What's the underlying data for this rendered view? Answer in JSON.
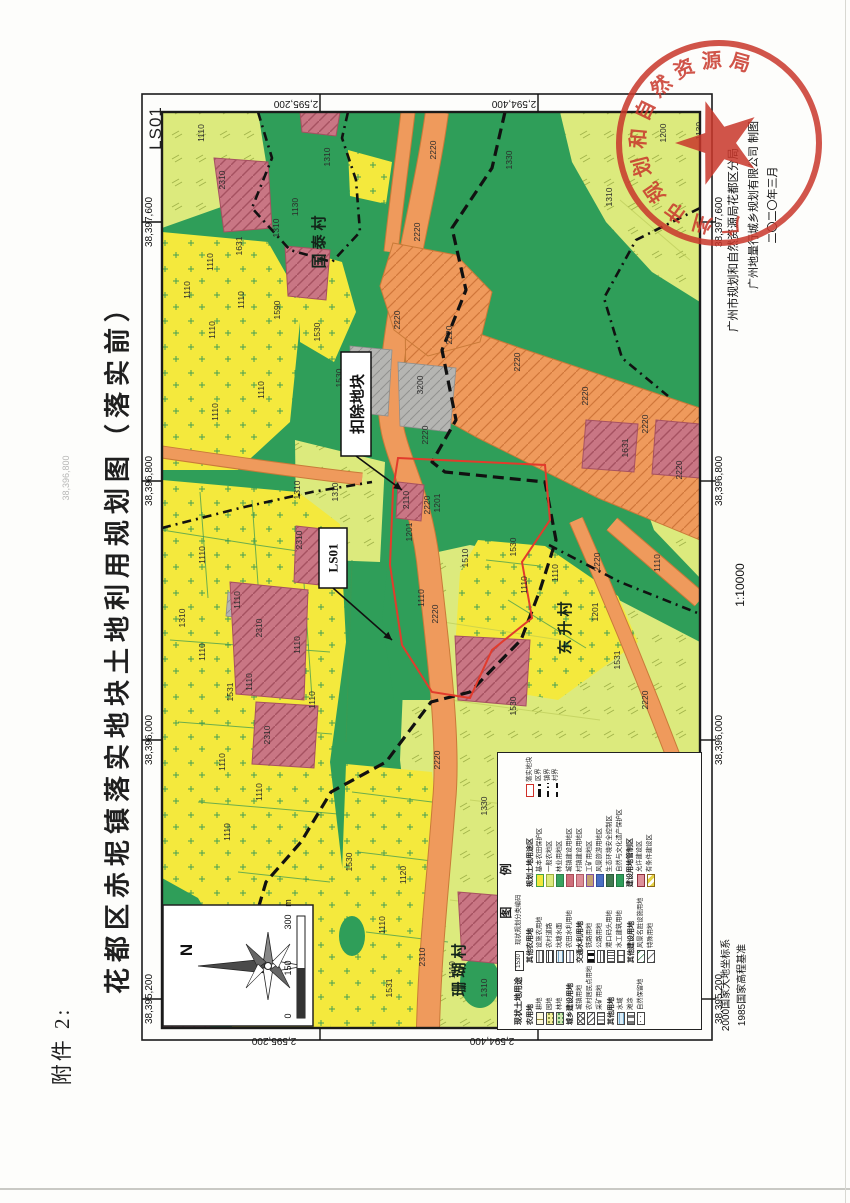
{
  "page": {
    "attachment_label": "附件 2:",
    "sheet_code": "LS01",
    "title": "花都区赤坭镇落实地块土地利用规划图（落实前）",
    "scale_text": "1:10000",
    "datum_line1": "2000国家大地坐标系",
    "datum_line2": "1985国家高程基准",
    "credit_line1": "广州市规划和自然资源局花都区分局",
    "credit_line2": "广州地量行城乡规划有限公司  制图",
    "credit_line3": "二〇二〇年三月",
    "ghost_label": "38,396,800"
  },
  "seal": {
    "arc_text": "广州市规划和自然资源局花都区分局",
    "color": "#c9372b"
  },
  "colors": {
    "green": "#2f9e59",
    "yellow": "#f4e93d",
    "ygreen": "#dcea7d",
    "orange": "#ef9a5c",
    "orange_edge": "#c97a38",
    "pink": "#c97684",
    "gray": "#b5b5b2",
    "red_line": "#e23b2c",
    "frame": "#1b1b1b"
  },
  "compass": {
    "north_label": "N",
    "scalebar_labels": [
      "0",
      "150",
      "300"
    ],
    "scalebar_unit": "m"
  },
  "map": {
    "easting_labels": [
      {
        "t": "38,397,600",
        "y": 222
      },
      {
        "t": "38,396,800",
        "y": 481
      },
      {
        "t": "38,396,000",
        "y": 740
      },
      {
        "t": "38,395,200",
        "y": 999
      }
    ],
    "northing_labels_top": [
      {
        "t": "2,595,200",
        "x": 296
      },
      {
        "t": "2,594,400",
        "x": 514
      }
    ],
    "northing_labels_bottom": [
      {
        "t": "2,595,200",
        "x": 274
      },
      {
        "t": "2,594,400",
        "x": 492
      }
    ],
    "tick_xs": [
      320,
      538
    ],
    "tick_ys": [
      222,
      481,
      740,
      999
    ],
    "villages": [
      {
        "name": "国泰村",
        "x": 324,
        "y": 240
      },
      {
        "name": "东升村",
        "x": 570,
        "y": 626
      },
      {
        "name": "珊瑚村",
        "x": 464,
        "y": 968
      }
    ],
    "callouts": [
      {
        "text": "扣除地块",
        "bx": 341,
        "by": 352,
        "bw": 30,
        "bh": 104,
        "lx1": 356,
        "ly1": 456,
        "lx2": 402,
        "ly2": 490,
        "fs": 15
      },
      {
        "text": "LS01",
        "bx": 319,
        "by": 528,
        "bw": 28,
        "bh": 60,
        "lx1": 333,
        "ly1": 588,
        "lx2": 392,
        "ly2": 640,
        "fs": 13
      }
    ],
    "codes": [
      {
        "t": "1200",
        "x": 666,
        "y": 133
      },
      {
        "t": "1130",
        "x": 702,
        "y": 131
      },
      {
        "t": "1310",
        "x": 612,
        "y": 197
      },
      {
        "t": "1330",
        "x": 512,
        "y": 160
      },
      {
        "t": "1310",
        "x": 330,
        "y": 157
      },
      {
        "t": "2220",
        "x": 436,
        "y": 150
      },
      {
        "t": "2220",
        "x": 420,
        "y": 232
      },
      {
        "t": "2220",
        "x": 400,
        "y": 320
      },
      {
        "t": "2220",
        "x": 452,
        "y": 335
      },
      {
        "t": "2220",
        "x": 520,
        "y": 362
      },
      {
        "t": "2220",
        "x": 588,
        "y": 396
      },
      {
        "t": "2220",
        "x": 648,
        "y": 424
      },
      {
        "t": "2220",
        "x": 682,
        "y": 470
      },
      {
        "t": "2220",
        "x": 428,
        "y": 435
      },
      {
        "t": "2220",
        "x": 430,
        "y": 505
      },
      {
        "t": "2220",
        "x": 600,
        "y": 562
      },
      {
        "t": "2220",
        "x": 648,
        "y": 700
      },
      {
        "t": "2220",
        "x": 438,
        "y": 614
      },
      {
        "t": "2220",
        "x": 440,
        "y": 760
      },
      {
        "t": "2310",
        "x": 225,
        "y": 180
      },
      {
        "t": "1110",
        "x": 204,
        "y": 133
      },
      {
        "t": "1130",
        "x": 298,
        "y": 207
      },
      {
        "t": "1310",
        "x": 279,
        "y": 228
      },
      {
        "t": "1631",
        "x": 242,
        "y": 246
      },
      {
        "t": "1110",
        "x": 213,
        "y": 262
      },
      {
        "t": "1590",
        "x": 280,
        "y": 310
      },
      {
        "t": "1110",
        "x": 190,
        "y": 290
      },
      {
        "t": "1110",
        "x": 215,
        "y": 330
      },
      {
        "t": "1110",
        "x": 244,
        "y": 300
      },
      {
        "t": "1110",
        "x": 264,
        "y": 390
      },
      {
        "t": "1110",
        "x": 218,
        "y": 412
      },
      {
        "t": "1530",
        "x": 320,
        "y": 332
      },
      {
        "t": "3200",
        "x": 423,
        "y": 385
      },
      {
        "t": "1530",
        "x": 342,
        "y": 378
      },
      {
        "t": "1310",
        "x": 300,
        "y": 490
      },
      {
        "t": "1310",
        "x": 338,
        "y": 492
      },
      {
        "t": "2310",
        "x": 302,
        "y": 540
      },
      {
        "t": "2110",
        "x": 409,
        "y": 500
      },
      {
        "t": "1201",
        "x": 440,
        "y": 503
      },
      {
        "t": "1201",
        "x": 412,
        "y": 532
      },
      {
        "t": "1510",
        "x": 468,
        "y": 558
      },
      {
        "t": "1110",
        "x": 424,
        "y": 598
      },
      {
        "t": "1530",
        "x": 516,
        "y": 547
      },
      {
        "t": "1110",
        "x": 527,
        "y": 585
      },
      {
        "t": "1110",
        "x": 558,
        "y": 573
      },
      {
        "t": "1201",
        "x": 598,
        "y": 612
      },
      {
        "t": "1531",
        "x": 620,
        "y": 660
      },
      {
        "t": "1530",
        "x": 516,
        "y": 706
      },
      {
        "t": "1110",
        "x": 660,
        "y": 563
      },
      {
        "t": "1631",
        "x": 628,
        "y": 448
      },
      {
        "t": "1110",
        "x": 205,
        "y": 555
      },
      {
        "t": "1110",
        "x": 240,
        "y": 600
      },
      {
        "t": "1310",
        "x": 185,
        "y": 618
      },
      {
        "t": "2310",
        "x": 262,
        "y": 628
      },
      {
        "t": "1531",
        "x": 233,
        "y": 692
      },
      {
        "t": "1110",
        "x": 205,
        "y": 652
      },
      {
        "t": "1110",
        "x": 252,
        "y": 682
      },
      {
        "t": "1110",
        "x": 300,
        "y": 645
      },
      {
        "t": "2310",
        "x": 270,
        "y": 735
      },
      {
        "t": "1110",
        "x": 225,
        "y": 762
      },
      {
        "t": "1110",
        "x": 262,
        "y": 792
      },
      {
        "t": "1110",
        "x": 230,
        "y": 832
      },
      {
        "t": "1110",
        "x": 315,
        "y": 700
      },
      {
        "t": "1330",
        "x": 487,
        "y": 806
      },
      {
        "t": "1130",
        "x": 570,
        "y": 800
      },
      {
        "t": "3200",
        "x": 645,
        "y": 862
      },
      {
        "t": "1530",
        "x": 352,
        "y": 862
      },
      {
        "t": "1120",
        "x": 406,
        "y": 875
      },
      {
        "t": "1110",
        "x": 385,
        "y": 925
      },
      {
        "t": "2310",
        "x": 425,
        "y": 957
      },
      {
        "t": "1531",
        "x": 392,
        "y": 988
      },
      {
        "t": "1110",
        "x": 455,
        "y": 970
      },
      {
        "t": "1310",
        "x": 487,
        "y": 988
      }
    ],
    "regions_ygreen": [
      "405,640 420,556 470,545 545,560 615,598 700,642 700,1028 430,1028 414,880 400,760",
      "560,112 700,112 700,302 652,272 606,222 572,162",
      "162,112 258,112 266,162 224,206 162,228",
      "645,412 700,432 700,578 654,530 632,468",
      "295,440 385,462 380,562 328,560 296,520"
    ],
    "regions_yellow": [
      "162,232 268,242 302,302 290,422 238,470 162,470",
      "162,480 298,492 340,524 346,642 330,762 346,900 330,1028 232,1028 228,948 198,898 162,878",
      "346,764 432,772 446,902 432,1028 330,1028 341,900",
      "478,540 545,546 618,596 638,642 558,700 498,690 455,650 460,572",
      "300,250 342,262 356,312 334,362 300,342",
      "348,150 392,162 386,204 350,196"
    ],
    "regions_green_over": [
      "388,560 432,560 446,642 430,700 394,700 382,620"
    ],
    "green_ellipses": [
      {
        "cx": 480,
        "cy": 982,
        "rx": 20,
        "ry": 26
      },
      {
        "cx": 352,
        "cy": 936,
        "rx": 13,
        "ry": 20
      },
      {
        "cx": 536,
        "cy": 824,
        "rx": 12,
        "ry": 16
      }
    ],
    "regions_gray": [
      "350,346 392,350 388,416 352,412",
      "398,362 456,368 450,432 400,426",
      "228,592 252,595 249,619 226,616",
      "600,756 648,762 643,804 597,798"
    ],
    "regions_pink": [
      "214,158 268,162 272,228 224,232",
      "285,246 330,250 326,300 288,296",
      "296,526 332,530 328,586 294,582",
      "230,582 308,590 304,700 236,694",
      "256,702 318,706 314,768 252,764",
      "455,636 530,640 526,706 458,700",
      "398,482 424,485 421,521 396,518",
      "458,892 530,898 524,966 462,960",
      "162,962 214,966 210,1028 162,1028",
      "586,420 638,424 634,472 582,468",
      "656,420 700,424 700,478 652,474",
      "300,112 340,112 336,136 302,132"
    ],
    "roads": [
      {
        "d": "M437,112 C425,200 398,290 390,390 C386,452 416,470 428,560 C438,650 450,742 444,802 C438,882 430,950 428,1028",
        "w": 22
      },
      {
        "d": "M408,112 C402,162 396,205 391,252",
        "w": 13
      },
      {
        "d": "M162,452 C230,462 300,472 362,479",
        "w": 11
      },
      {
        "d": "M612,524 L700,600",
        "w": 15
      },
      {
        "d": "M576,520 C620,620 660,720 692,806",
        "w": 13
      }
    ],
    "road_polys": [
      "405,308 520,348 700,408 700,540 598,498 478,438 406,398",
      "393,243 456,255 492,292 480,342 428,356 394,330 380,286"
    ],
    "field_lines": [
      "162,530 250,544 332,556",
      "200,492 208,598",
      "252,500 262,640",
      "300,526 312,698",
      "170,640 330,652",
      "178,722 332,734",
      "198,802 338,814",
      "238,872 330,882",
      "352,792 432,802",
      "358,852 440,862",
      "366,932 448,942",
      "486,560 540,566",
      "508,600 586,648",
      "470,906 520,962",
      "352,560 346,742"
    ],
    "ygreen_lines": [
      "430,620 560,640",
      "450,700 600,720",
      "470,800 640,820",
      "450,900 620,920",
      "480,1000 640,1010",
      "620,200 690,260"
    ],
    "boundaries": [
      {
        "pts": "505,112 492,168 452,228 466,290 442,350 456,420 432,462 445,472 545,482 556,540 540,590 521,640 470,692 431,702 386,762 331,792 301,842 266,882 246,950 232,1028",
        "w": 3.2,
        "dash": "11 6"
      },
      {
        "pts": "549,545 620,582 700,614",
        "w": 2.6,
        "dash": "9 5 2 5"
      },
      {
        "pts": "162,528 240,508 312,492 372,482",
        "w": 2.6,
        "dash": "9 5 2 5"
      },
      {
        "pts": "258,112 272,158 252,208 290,250 332,262 360,232 356,180 342,138 348,112",
        "w": 2.6,
        "dash": "9 5 2 5"
      },
      {
        "pts": "700,208 636,240 604,298 622,358 668,396",
        "w": 2.6,
        "dash": "9 5 2 5"
      }
    ],
    "red_parcel": "398,458 545,465 550,520 522,562 532,618 492,650 470,698 432,692 402,645 390,565 393,490"
  },
  "legend": {
    "title": "图  例",
    "current_title": "现状土地用途",
    "code_sample": {
      "code": "1530",
      "label": "现状规划分类编码"
    },
    "groups_col1": [
      {
        "header": "农用地",
        "items": [
          {
            "label": "耕地",
            "sw": "sw-gengdi"
          },
          {
            "label": "园地",
            "sw": "sw-yuandi"
          },
          {
            "label": "林地",
            "sw": "sw-lindi"
          }
        ]
      },
      {
        "header": "城乡建设用地",
        "items": [
          {
            "label": "城镇用地",
            "sw": "sw-cross"
          },
          {
            "label": "农村居民点用地",
            "sw": "sw-diag"
          },
          {
            "label": "采矿用地",
            "sw": "sw-vlines"
          }
        ]
      },
      {
        "header": "其他用地",
        "items": [
          {
            "label": "水域",
            "sw": "sw-water"
          },
          {
            "label": "滩涂",
            "sw": "sw-tantu"
          },
          {
            "label": "自然保留地",
            "sw": "sw-dots"
          }
        ]
      }
    ],
    "groups_col2": [
      {
        "header": "其他农用地",
        "items": [
          {
            "label": "设施农用地",
            "sw": "sw-hlines"
          },
          {
            "label": "农村道路",
            "sw": "sw-road"
          },
          {
            "label": "坑塘水面",
            "sw": "sw-pond"
          },
          {
            "label": "农田水利用地",
            "sw": "sw-tilde"
          }
        ]
      },
      {
        "header": "交通水利用地",
        "items": [
          {
            "label": "铁路用地",
            "sw": "sw-rail"
          },
          {
            "label": "公路用地",
            "sw": "sw-gonglu"
          },
          {
            "label": "港口码头用地",
            "sw": "sw-vlines2"
          },
          {
            "label": "水工建筑用地",
            "sw": "sw-shuigong"
          }
        ]
      },
      {
        "header": "其他建设用地",
        "items": [
          {
            "label": "风景名胜设施用地",
            "sw": "sw-fengjing"
          },
          {
            "label": "特殊用地",
            "sw": "sw-teshu"
          }
        ]
      }
    ],
    "planned_title": "规划土地用途区",
    "planned_items": [
      {
        "label": "基本农田保护区",
        "fill": "#f2e83a",
        "border": "#43a047"
      },
      {
        "label": "一般农地区",
        "fill": "#dcea7d",
        "border": "#9aad3e"
      },
      {
        "label": "林业用地区",
        "fill": "#38a35f",
        "border": "#2c8049"
      },
      {
        "label": "城镇建设用地区",
        "fill": "#cf6e7a",
        "border": "#a84b57"
      },
      {
        "label": "村镇建设用地区",
        "fill": "#dd8d97",
        "border": "#b05c67"
      },
      {
        "label": "工矿用地区",
        "fill": "#c4a271",
        "border": "#7b4fa0"
      },
      {
        "label": "风景旅游用地区",
        "fill": "#4a6fc3",
        "border": "#32509a"
      },
      {
        "label": "生态环境安全控制区",
        "fill": "#41794f",
        "border": "#2c5c39"
      },
      {
        "label": "自然与文化遗产保护区",
        "fill": "#2f9e5a",
        "border": "#237a43"
      }
    ],
    "control_title": "建设用地管制区",
    "control_items": [
      {
        "label": "允许建设区",
        "fill": "#de919b",
        "border": "#8e2f3c"
      },
      {
        "label": "有条件建设区",
        "sw": "sw-conditional"
      }
    ],
    "boundary_items": [
      {
        "label": "落实地块",
        "sw": "sw-redbox",
        "line": false
      },
      {
        "label": "区界",
        "sw": "sw-qujie",
        "line": true
      },
      {
        "label": "镇界",
        "sw": "sw-zhenjie",
        "line": true
      },
      {
        "label": "村界",
        "sw": "sw-cunjie",
        "line": true
      }
    ]
  }
}
